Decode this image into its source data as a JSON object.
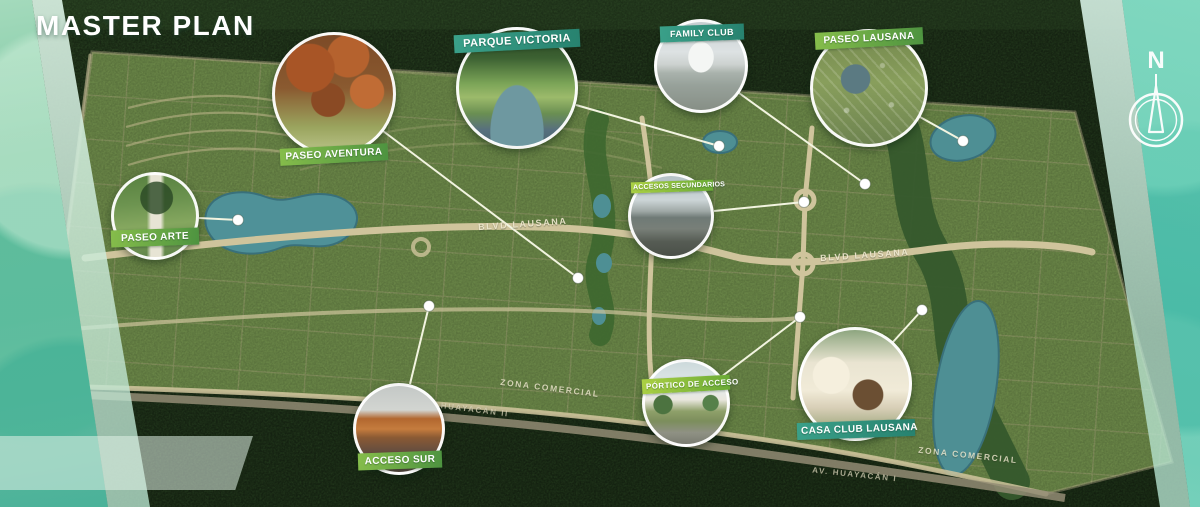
{
  "page": {
    "title": "MASTER PLAN"
  },
  "compass": {
    "label": "N"
  },
  "callouts": [
    {
      "id": "paseo-arte",
      "label": "PASEO ARTE"
    },
    {
      "id": "paseo-aventura",
      "label": "PASEO AVENTURA"
    },
    {
      "id": "parque-victoria",
      "label": "PARQUE VICTORIA"
    },
    {
      "id": "family-club",
      "label": "FAMILY CLUB"
    },
    {
      "id": "paseo-lausana",
      "label": "PASEO LAUSANA"
    },
    {
      "id": "accesos-secundarios",
      "label": "ACCESOS SECUNDARIOS"
    },
    {
      "id": "acceso-sur",
      "label": "ACCESO SUR"
    },
    {
      "id": "portico-de-acceso",
      "label": "PÓRTICO DE ACCESO"
    },
    {
      "id": "casa-club-lausana",
      "label": "CASA CLUB LAUSANA"
    }
  ],
  "road_labels": [
    {
      "label": "BLVD LAUSANA"
    },
    {
      "label": "BLVD LAUSANA"
    },
    {
      "label": "ZONA COMERCIAL"
    },
    {
      "label": "ZONA COMERCIAL"
    },
    {
      "label": "AV. HUAYACÁN II"
    },
    {
      "label": "AV. HUAYACÁN I"
    }
  ],
  "colors": {
    "jungle": "#2c4526",
    "development": "#7a9857",
    "road": "#c9bf9a",
    "water": "#4e8f94",
    "banner_green": "#5aa243",
    "banner_teal": "#2f9080",
    "banner_lime": "#8abf3a",
    "watercolor_teal": "#62c4b4",
    "leader_line": "#f2f4e0"
  }
}
